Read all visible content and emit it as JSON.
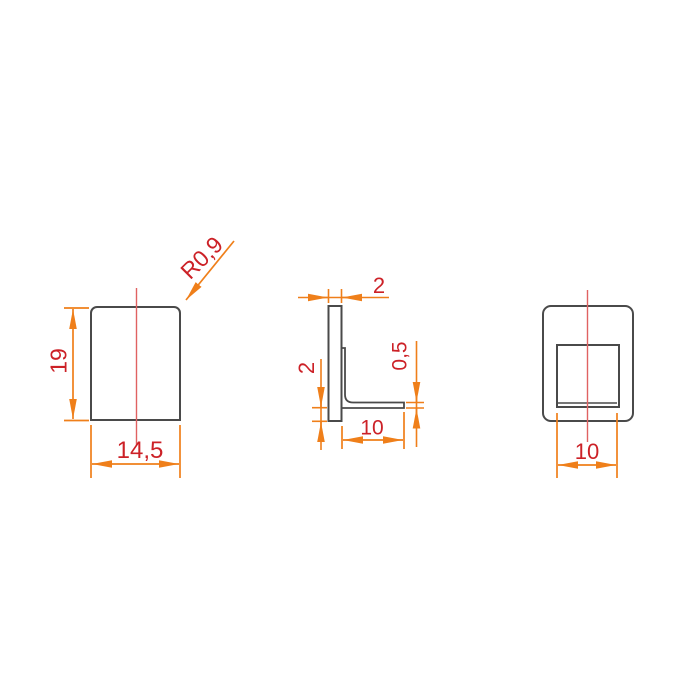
{
  "drawing": {
    "background": "#ffffff",
    "colors": {
      "outline": "#4a4a4a",
      "dimension_lines": "#ef7f1a",
      "dimension_text": "#cc2127",
      "centerline": "#e06262"
    },
    "views": {
      "front": {
        "dims": {
          "height": "19",
          "width": "14,5",
          "corner_radius": "R0,9"
        }
      },
      "side": {
        "dims": {
          "wall_thickness": "2",
          "bottom_lip": "2",
          "flange_thickness": "0,5",
          "flange_length": "10"
        }
      },
      "back": {
        "dims": {
          "opening_width": "10"
        }
      }
    }
  }
}
